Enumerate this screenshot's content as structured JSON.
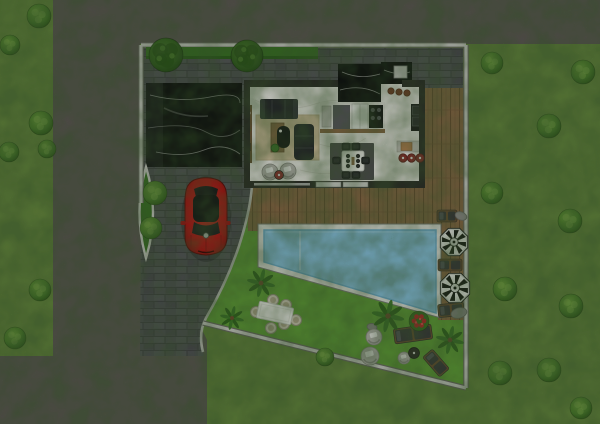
{
  "meta": {
    "kind": "architectural-site-plan-render",
    "width": 600,
    "height": 424
  },
  "palette": {
    "lawn_outer": "#66883f",
    "lawn_garden": "#61a038",
    "road": "#5d5855",
    "brick": "#515156",
    "brick_joint": "#424246",
    "brick_lite": "#5a5a60",
    "wall_light": "#d3d2cf",
    "wall_shadow": "#6e6b67",
    "wall_dark": "#2c2a28",
    "house_floor": "#f0eeea",
    "marble_black": "#0e0e10",
    "marble_vein": "#e8e8e8",
    "wood_deck": "#8a6847",
    "wood_line": "#6b4e33",
    "pool_water": "#8ac6e6",
    "pool_border": "#e9e9e6",
    "pool_rim": "#6fb0d4",
    "hedge": "#3a7326",
    "rug_beige": "#d6c3a2",
    "rug_dark": "#4e4e50",
    "sofa": "#26282b",
    "car_red": "#b51717",
    "car_dark": "#141416",
    "umbrella_dark": "#161616",
    "umbrella_light": "#f4f4f2",
    "chair_tan": "#d2cbba",
    "lounger_cushion": "#3a3a3c",
    "lounger_wood": "#6b4e33",
    "table_white": "#f6f5f2",
    "stool_red": "#8e2c2c",
    "pouf_gray": "#b7b5b1"
  },
  "areas": [
    "road",
    "street-lawn",
    "driveway",
    "marble-parking-pad",
    "entrance-island",
    "house",
    "kitchen",
    "living-room",
    "dining-area",
    "wood-deck",
    "swimming-pool",
    "garden-lawn"
  ],
  "scene": {
    "outer_bushes": [
      [
        39,
        16,
        12
      ],
      [
        10,
        45,
        10
      ],
      [
        41,
        123,
        12
      ],
      [
        9,
        152,
        10
      ],
      [
        47,
        149,
        9
      ],
      [
        40,
        290,
        11
      ],
      [
        15,
        338,
        11
      ],
      [
        492,
        63,
        11
      ],
      [
        583,
        72,
        12
      ],
      [
        549,
        126,
        12
      ],
      [
        492,
        193,
        11
      ],
      [
        570,
        221,
        12
      ],
      [
        505,
        289,
        12
      ],
      [
        571,
        306,
        12
      ],
      [
        500,
        373,
        12
      ],
      [
        549,
        370,
        12
      ],
      [
        581,
        408,
        11
      ],
      [
        325,
        357,
        9
      ]
    ],
    "entrance_bushes": [
      [
        155,
        193,
        12
      ],
      [
        151,
        228,
        11
      ]
    ],
    "trees": [
      [
        166,
        55,
        17
      ],
      [
        247,
        56,
        16
      ]
    ],
    "palms": [
      [
        261,
        283,
        13
      ],
      [
        388,
        316,
        15
      ],
      [
        450,
        340,
        13
      ],
      [
        232,
        318,
        11
      ]
    ],
    "flower_bushes": [
      [
        419,
        321,
        10
      ]
    ],
    "rocks": [
      [
        461,
        216,
        6,
        4,
        20
      ],
      [
        459,
        313,
        8,
        5,
        -15
      ],
      [
        372,
        327,
        5,
        3.5,
        10
      ]
    ],
    "umbrellas": [
      [
        454,
        242,
        14
      ],
      [
        455,
        288,
        15
      ]
    ],
    "loungers": [
      {
        "x": 447,
        "y": 216,
        "w": 20,
        "h": 12,
        "rot": 0
      },
      {
        "x": 450,
        "y": 265,
        "w": 24,
        "h": 12,
        "rot": 0
      },
      {
        "x": 451,
        "y": 310,
        "w": 26,
        "h": 13,
        "rot": -5
      },
      {
        "x": 413,
        "y": 334,
        "w": 38,
        "h": 15,
        "rot": -8
      },
      {
        "x": 436,
        "y": 363,
        "w": 26,
        "h": 13,
        "rot": 49
      }
    ],
    "poufs": [
      [
        374,
        337,
        8
      ],
      [
        370,
        356,
        9
      ],
      [
        404,
        358,
        6
      ],
      [
        270,
        172,
        8
      ],
      [
        288,
        171,
        8
      ]
    ],
    "side_tables": [
      {
        "x": 414,
        "y": 353,
        "r": 5.5,
        "color": "#2e2b28"
      },
      {
        "x": 279,
        "y": 175,
        "r": 4.5,
        "color": "#8e3030"
      }
    ],
    "garden_table": {
      "x": 275,
      "y": 313,
      "w": 35,
      "h": 17,
      "rot": 12
    },
    "garden_chairs": [
      [
        273,
        300
      ],
      [
        286,
        305
      ],
      [
        256,
        312
      ],
      [
        296,
        320
      ],
      [
        271,
        328
      ],
      [
        284,
        324
      ]
    ],
    "dining_chairs": [
      [
        346,
        146.5
      ],
      [
        356,
        146.5
      ],
      [
        346,
        175
      ],
      [
        356,
        175
      ],
      [
        336.5,
        160.5
      ],
      [
        365.5,
        160.5
      ]
    ],
    "bar_stools": [
      [
        403,
        158
      ],
      [
        411.5,
        158
      ],
      [
        420,
        158
      ]
    ],
    "island_bowls": [
      [
        391,
        91
      ],
      [
        399,
        92
      ],
      [
        407,
        93
      ]
    ]
  }
}
